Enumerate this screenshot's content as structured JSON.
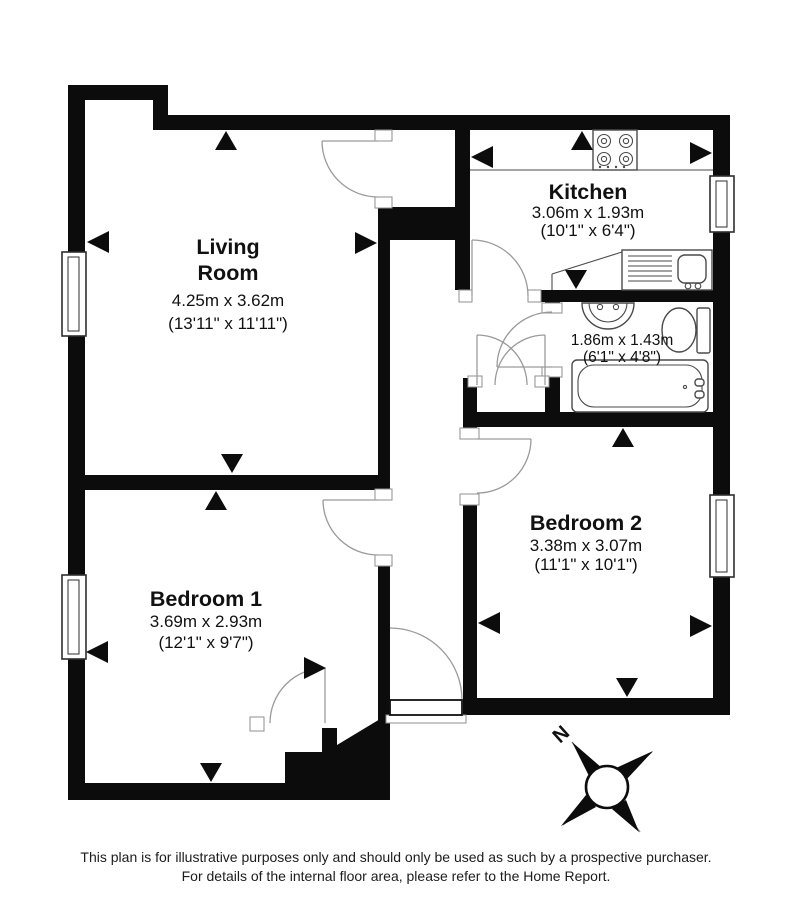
{
  "plan": {
    "rooms": {
      "living": {
        "name_line1": "Living",
        "name_line2": "Room",
        "metric": "4.25m x 3.62m",
        "imperial": "(13'11\" x 11'11\")"
      },
      "kitchen": {
        "name": "Kitchen",
        "metric": "3.06m x 1.93m",
        "imperial": "(10'1\" x 6'4\")"
      },
      "bathroom": {
        "metric": "1.86m x 1.43m",
        "imperial": "(6'1\" x 4'8\")"
      },
      "bedroom1": {
        "name": "Bedroom 1",
        "metric": "3.69m x 2.93m",
        "imperial": "(12'1\" x 9'7\")"
      },
      "bedroom2": {
        "name": "Bedroom 2",
        "metric": "3.38m x 3.07m",
        "imperial": "(11'1\" x 10'1\")"
      }
    },
    "compass": {
      "north_label": "N"
    },
    "colors": {
      "wall": "#0c0c0c",
      "background": "#ffffff",
      "thin_line": "#9a9a9a"
    }
  },
  "footer": {
    "line1": "This plan is for illustrative purposes only and should only be used as such by a prospective purchaser.",
    "line2": "For details of the internal floor area, please refer to the Home Report."
  }
}
